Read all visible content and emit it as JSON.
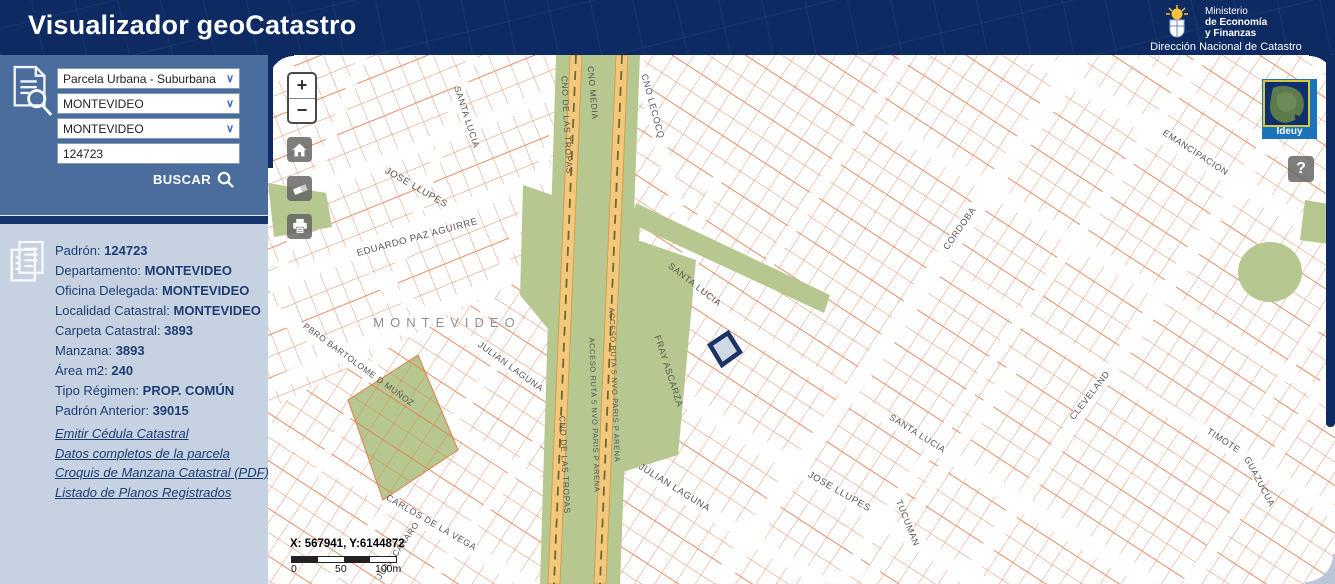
{
  "header": {
    "title": "Visualizador geoCatastro",
    "ministry_line1": "Ministerio",
    "ministry_line2": "de Economía",
    "ministry_line3": "y Finanzas",
    "subtitle": "Dirección Nacional de Catastro"
  },
  "search": {
    "layer": "Parcela Urbana - Suburbana",
    "department": "MONTEVIDEO",
    "locality": "MONTEVIDEO",
    "padron_value": "124723",
    "buscar_label": "BUSCAR"
  },
  "info": {
    "rows": [
      {
        "label": "Padrón:",
        "value": "124723"
      },
      {
        "label": "Departamento:",
        "value": "MONTEVIDEO"
      },
      {
        "label": "Oficina Delegada:",
        "value": "MONTEVIDEO"
      },
      {
        "label": "Localidad Catastral:",
        "value": "MONTEVIDEO"
      },
      {
        "label": "Carpeta Catastral:",
        "value": "3893"
      },
      {
        "label": "Manzana:",
        "value": "3893"
      },
      {
        "label": "Área m2:",
        "value": "240"
      },
      {
        "label": "Tipo Régimen:",
        "value": "PROP. COMÚN"
      },
      {
        "label": "Padrón Anterior:",
        "value": "39015"
      }
    ],
    "links": [
      "Emitir Cédula Catastral",
      "Datos completos de la parcela",
      "Croquis de Manzana Catastral (PDF)",
      "Listado de Planos Registrados"
    ]
  },
  "map": {
    "controls": {
      "zoom_in": "+",
      "zoom_out": "−",
      "help": "?"
    },
    "basemap_label": "Ideuy",
    "coordinates": "X: 567941, Y:6144872",
    "scale": {
      "start": "0",
      "mid": "50",
      "end": "100m"
    },
    "place_label": "MONTEVIDEO",
    "street_labels": [
      {
        "text": "SANTA LUCIA",
        "x": 196,
        "y": 63,
        "r": 72,
        "s": 9
      },
      {
        "text": "CNO MEDIA",
        "x": 322,
        "y": 38,
        "r": 85,
        "s": 8.5
      },
      {
        "text": "CNO LECOCQ",
        "x": 382,
        "y": 52,
        "r": 75,
        "s": 9
      },
      {
        "text": "CNO DE LAS TROPAS",
        "x": 296,
        "y": 70,
        "r": 87,
        "s": 8.5
      },
      {
        "text": "CNO DE LAS TROPAS",
        "x": 294,
        "y": 410,
        "r": 87,
        "s": 8.5
      },
      {
        "text": "ACCESO RUTA 5 NVO PARIS P ARENA",
        "x": 324,
        "y": 360,
        "r": 88,
        "s": 7.5
      },
      {
        "text": "ACCESO RUTA 5 NVO PARIS P ARENA",
        "x": 344,
        "y": 330,
        "r": 88,
        "s": 7.5
      },
      {
        "text": "JOSE LLUPES",
        "x": 147,
        "y": 135,
        "r": 30,
        "s": 9.5
      },
      {
        "text": "EDUARDO PAZ AGUIRRE",
        "x": 150,
        "y": 185,
        "r": -15,
        "s": 9.5
      },
      {
        "text": "PBRO BARTOLOME D MUÑOZ",
        "x": 89,
        "y": 312,
        "r": 36,
        "s": 8.5
      },
      {
        "text": "JULIAN LAGUNA",
        "x": 241,
        "y": 314,
        "r": 36,
        "s": 9
      },
      {
        "text": "FRAY ASCARZA",
        "x": 398,
        "y": 317,
        "r": 72,
        "s": 9
      },
      {
        "text": "SANTA LUCIA",
        "x": 425,
        "y": 232,
        "r": 38,
        "s": 9
      },
      {
        "text": "JULIAN LAGUNA",
        "x": 405,
        "y": 435,
        "r": 32,
        "s": 9.5
      },
      {
        "text": "JOSE LLUPES",
        "x": 570,
        "y": 439,
        "r": 30,
        "s": 9.5
      },
      {
        "text": "SANTA LUCIA",
        "x": 648,
        "y": 381,
        "r": 32,
        "s": 9
      },
      {
        "text": "TUCUMAN",
        "x": 637,
        "y": 469,
        "r": 68,
        "s": 9
      },
      {
        "text": "CARLOS DE LA VEGA",
        "x": 162,
        "y": 470,
        "r": 30,
        "s": 9
      },
      {
        "text": "JUAN CANARO",
        "x": 132,
        "y": 497,
        "r": -55,
        "s": 8.5
      },
      {
        "text": "CORDOBA",
        "x": 694,
        "y": 175,
        "r": -55,
        "s": 9
      },
      {
        "text": "EMANCIPACION",
        "x": 926,
        "y": 100,
        "r": 33,
        "s": 9
      },
      {
        "text": "CLEVELAND",
        "x": 824,
        "y": 342,
        "r": -52,
        "s": 9
      },
      {
        "text": "TIMOTE",
        "x": 954,
        "y": 388,
        "r": 33,
        "s": 9
      },
      {
        "text": "GUAZUCUA",
        "x": 989,
        "y": 428,
        "r": 62,
        "s": 9
      }
    ]
  },
  "colors": {
    "header_navy": "#0d2a63",
    "sidebar_blue": "#4a6d9e",
    "info_bg": "#c6d2e2",
    "text_navy": "#1e3d72",
    "parcel_line": "#e27a4b",
    "green_area": "#b6c88f",
    "road_fill": "#f3c87c",
    "selected_parcel": "#1b3468",
    "basemap_btn_blue": "#1a74bb"
  }
}
